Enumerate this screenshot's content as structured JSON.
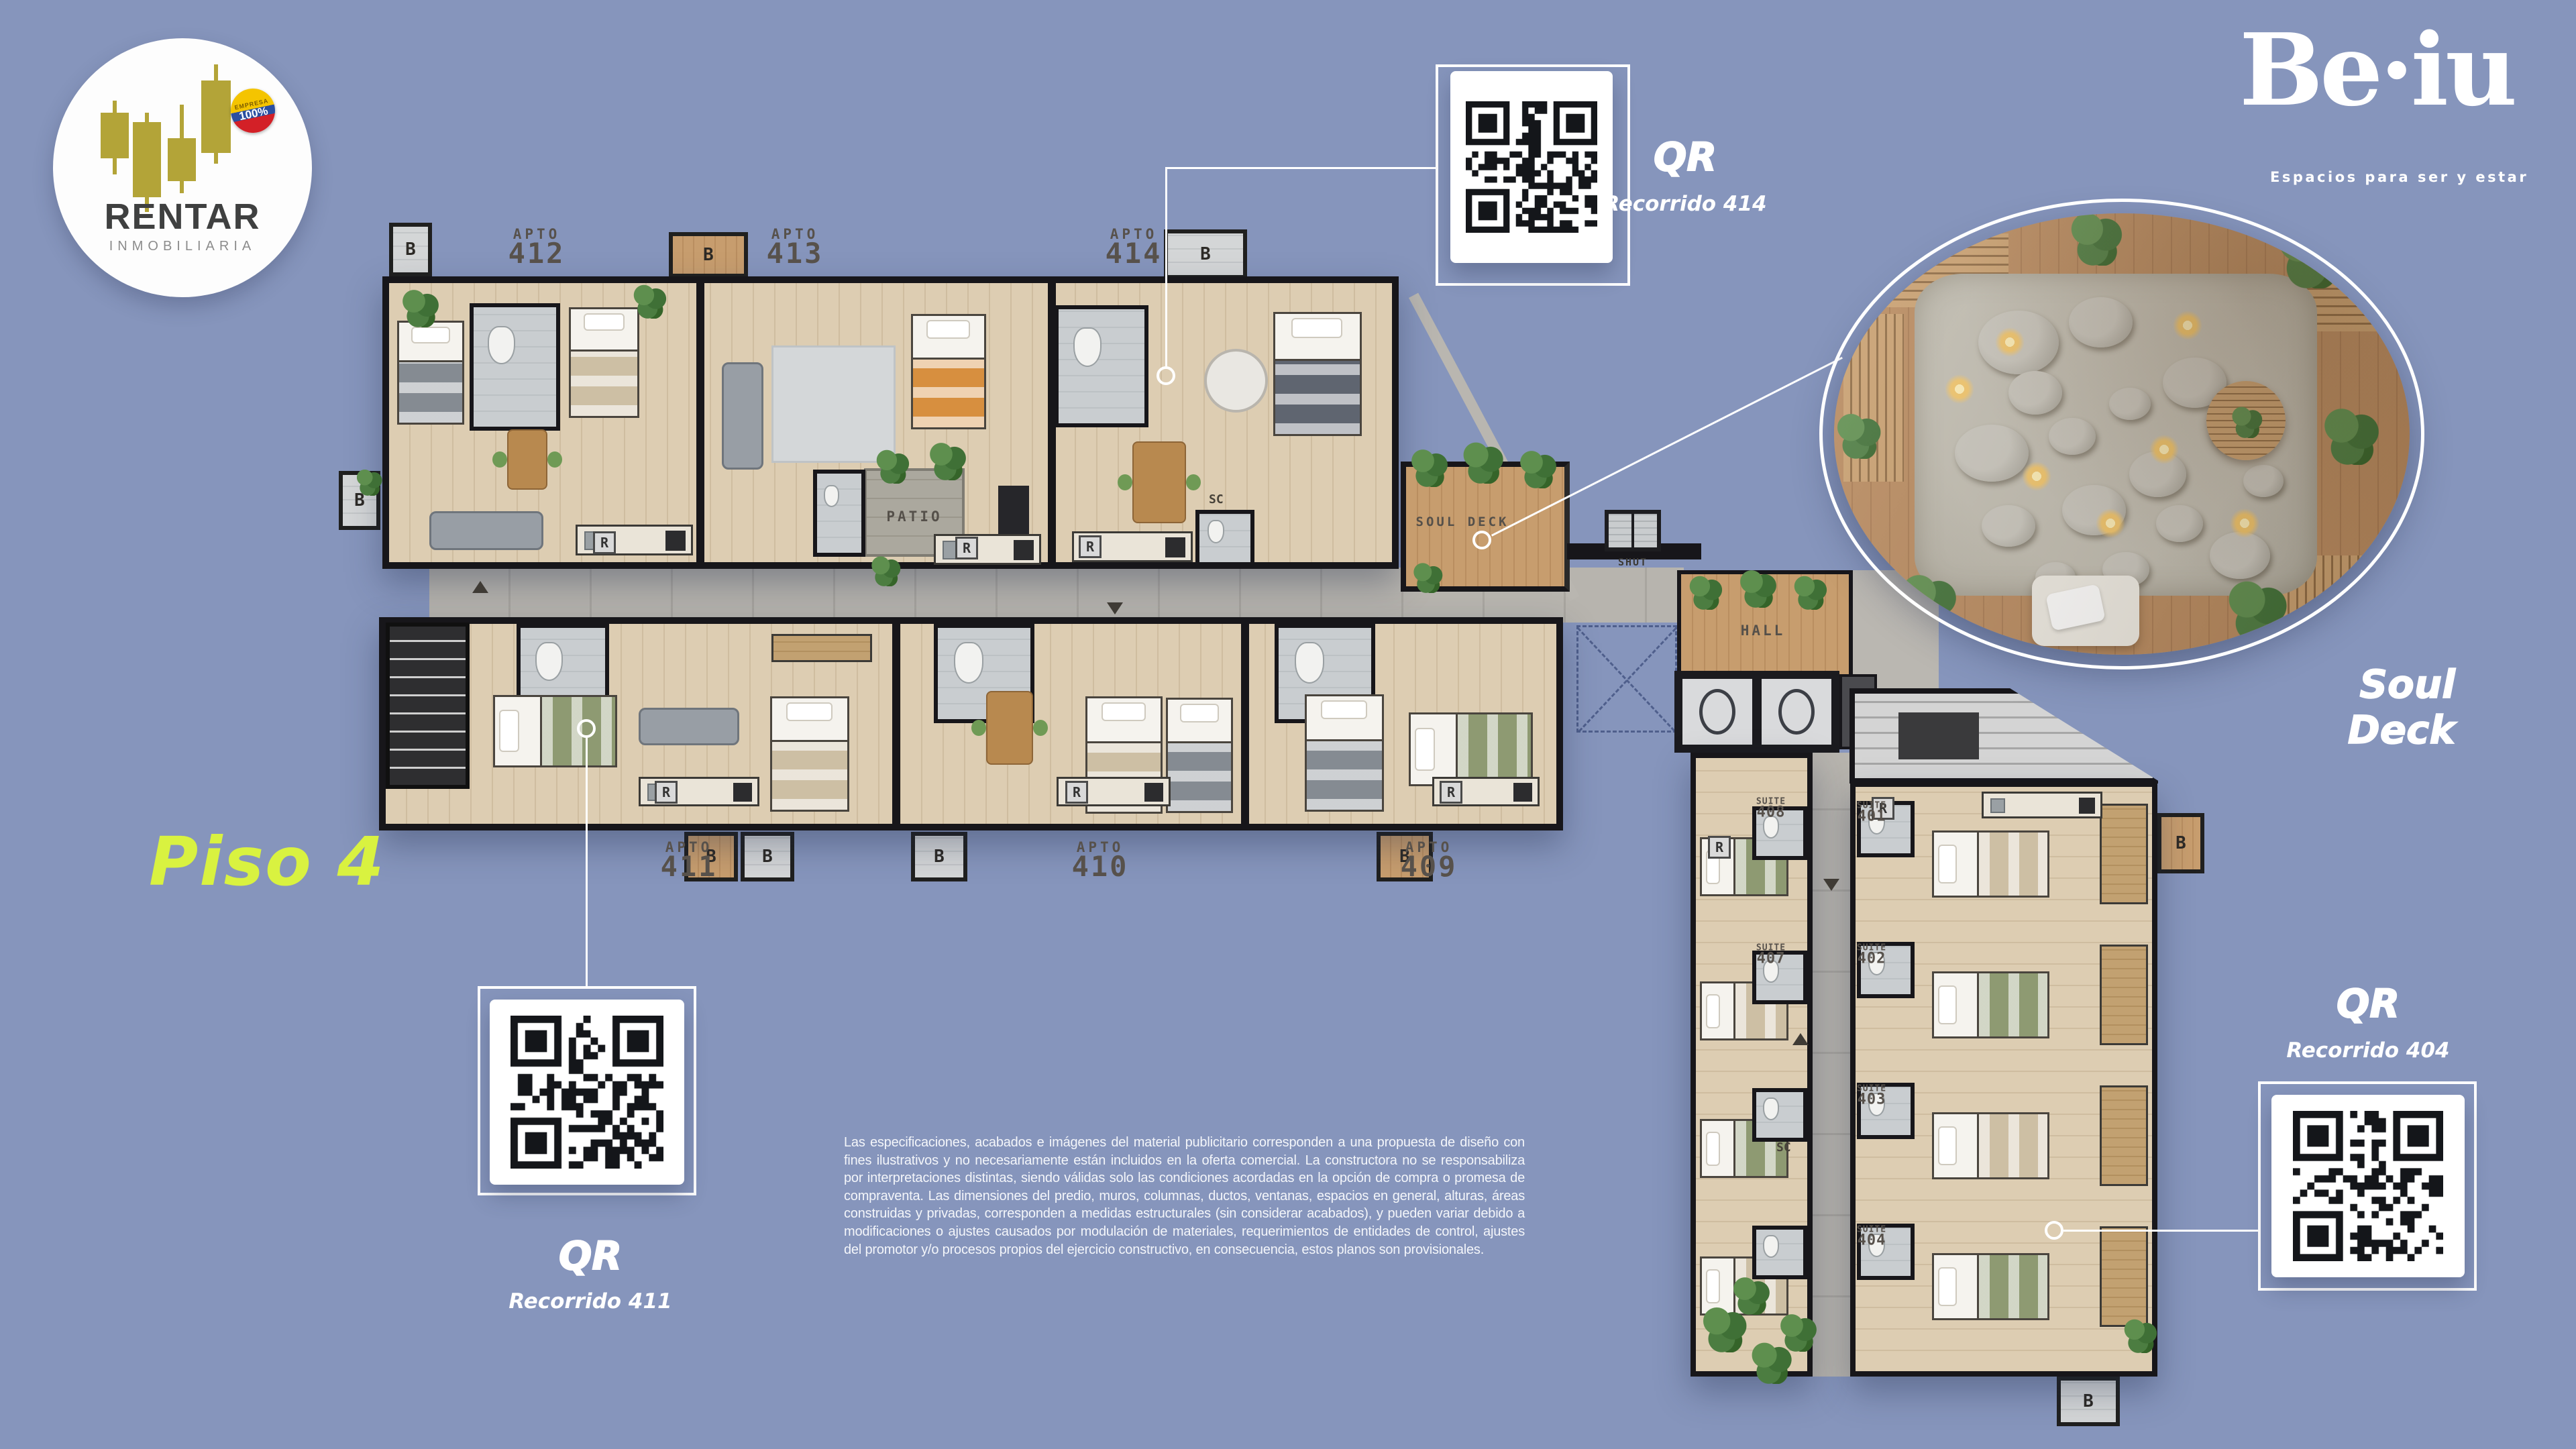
{
  "background_color": "#8695bc",
  "accent_color": "#d9f240",
  "rentar": {
    "name": "RENTAR",
    "subtitle": "INMOBILIARIA",
    "badge_top": "EMPRESA",
    "badge_value": "100%"
  },
  "beiu": {
    "name": "Be·iu",
    "tagline": "Espacios para ser y estar"
  },
  "floor_title": "Piso 4",
  "soul_deck": {
    "caption": "Soul Deck"
  },
  "qr_blocks": [
    {
      "id": "414",
      "title": "QR",
      "subtitle": "Recorrido 414"
    },
    {
      "id": "411",
      "title": "QR",
      "subtitle": "Recorrido 411"
    },
    {
      "id": "404",
      "title": "QR",
      "subtitle": "Recorrido 404"
    }
  ],
  "plan": {
    "apartment_prefix": "APTO",
    "apartments": [
      "412",
      "413",
      "414",
      "411",
      "410",
      "409"
    ],
    "suite_prefix": "SUITE",
    "suites": [
      "401",
      "402",
      "403",
      "404",
      "407",
      "408"
    ],
    "areas": {
      "patio": "PATIO",
      "soul_deck": "SOUL DECK",
      "hall": "HALL",
      "chute": "SHUT"
    },
    "balcony_badge": "B",
    "fridge_badge": "R",
    "utility_badge": "SC"
  },
  "disclaimer": "Las especificaciones, acabados e imágenes del material publicitario corresponden a una propuesta de diseño con fines ilustrativos y no necesariamente están incluidos en la oferta comercial. La constructora no se responsabiliza por interpretaciones distintas, siendo válidas solo las condiciones acordadas en la opción de compra o promesa de compraventa. Las dimensiones del predio, muros, columnas, ductos, ventanas, espacios en general, alturas, áreas construidas y privadas, corresponden a medidas estructurales (sin considerar acabados), y pueden variar debido a modificaciones o ajustes causados por modulación de materiales, requerimientos de entidades de control, ajustes del promotor y/o procesos propios del ejercicio constructivo, en consecuencia, estos planos son provisionales."
}
